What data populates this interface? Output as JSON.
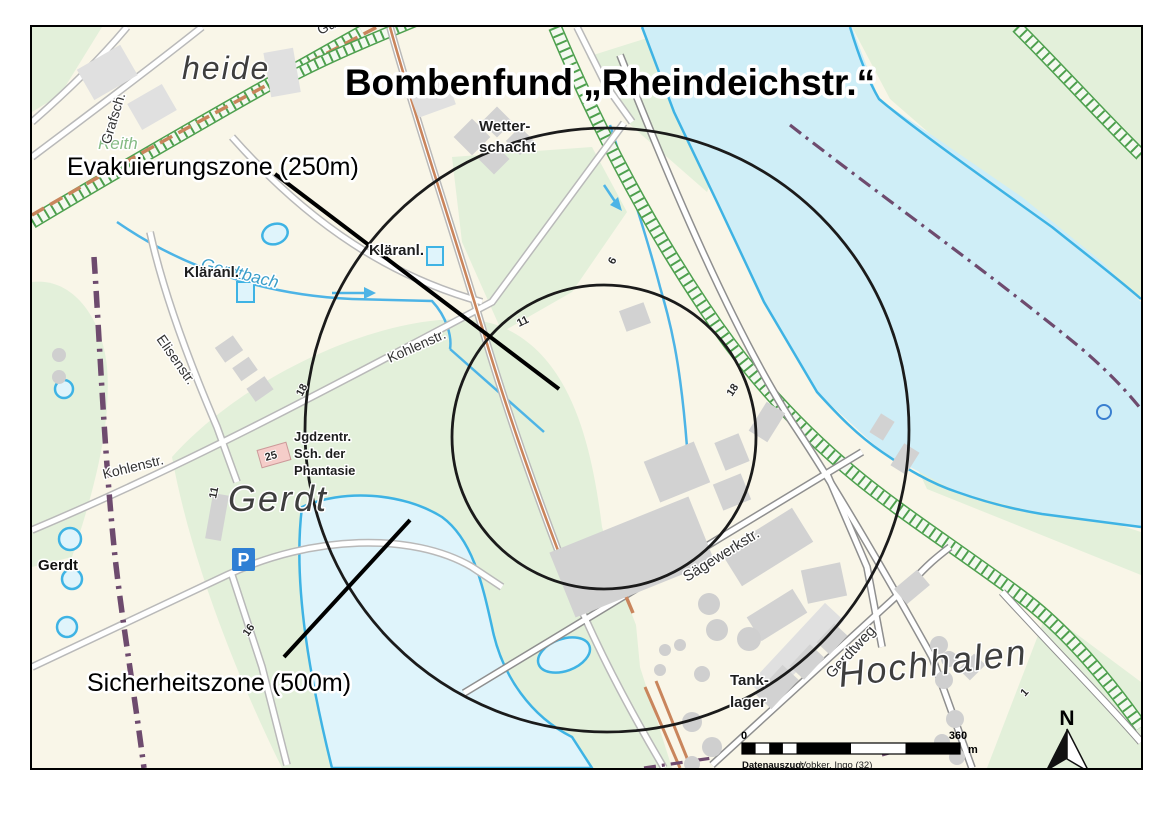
{
  "title": "Bombenfund „Rheindeichstr.“",
  "annotations": {
    "evacuation_zone": "Evakuierungszone (250m)",
    "security_zone": "Sicherheitszone (500m)"
  },
  "places": {
    "heide": "heide",
    "reith": "Reith",
    "gerdt_area": "Gerdt",
    "hochhalen": "Hochhalen",
    "gerdt_stop": "Gerdt"
  },
  "streets": {
    "grafschaft": "Grafsch.",
    "gueterbahn": "Güterba",
    "elisenstr": "Elisenstr.",
    "kohlenstr_west": "Kohlenstr.",
    "kohlenstr_mid": "Kohlenstr.",
    "saegewerkstr": "Sägewerkstr.",
    "gerdtweg": "Gerdtweg"
  },
  "waters": {
    "gerdtbach": "Gerdtbach"
  },
  "pois": {
    "wetterschacht_line1": "Wetter-",
    "wetterschacht_line2": "schacht",
    "klaeranl_west": "Kläranl.",
    "klaeranl_mid": "Kläranl.",
    "jgdzentr_line1": "Jgdzentr.",
    "jgdzentr_line2": "Sch. der",
    "jgdzentr_line3": "Phantasie",
    "tanklager_line1": "Tank-",
    "tanklager_line2": "lager",
    "parking": "P"
  },
  "house_numbers": {
    "hn25": "25",
    "hn11a": "11",
    "hn11b": "11",
    "hn18a": "18",
    "hn18b": "18",
    "hn16": "16",
    "hn6": "6",
    "hn1": "1"
  },
  "scalebar": {
    "start": "0",
    "end": "360",
    "unit": "m"
  },
  "north_label": "N",
  "attribution": {
    "label": "Datenauszug:",
    "value": "Vobker, Ingo (32)"
  },
  "colors": {
    "land": "#f9f6e8",
    "green_area": "#e3f0da",
    "water_fill": "#cfeef7",
    "water_line": "#3eb3e4",
    "building": "#d2d2d2",
    "pink_building": "#f5cdc9",
    "major_road": "#c9855c",
    "dike_green": "#4ea04e",
    "boundary": "#6e4b6e",
    "zone_circle": "#1b1b1b",
    "parking_blue": "#2f7fd4"
  }
}
